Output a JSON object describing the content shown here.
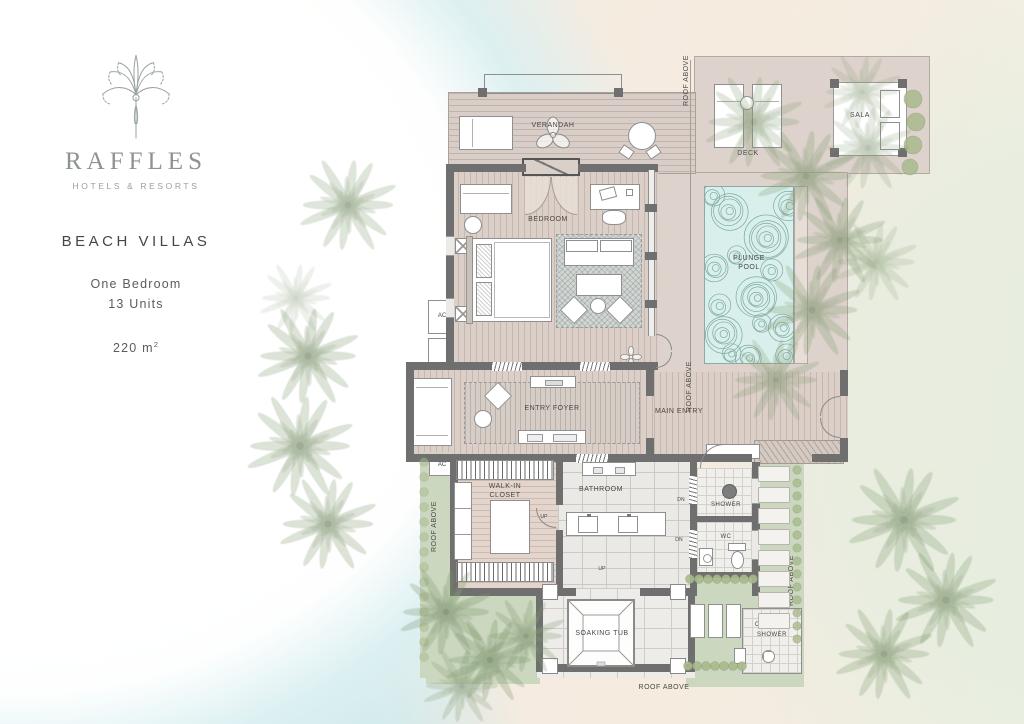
{
  "panel": {
    "brand": "RAFFLES",
    "tagline": "HOTELS & RESORTS",
    "title": "BEACH VILLAS",
    "unit_type": "One Bedroom",
    "unit_count": "13 Units",
    "area": "220 m",
    "area_sup": "2"
  },
  "plan": {
    "labels": {
      "verandah": "VERANDAH",
      "bedroom": "BEDROOM",
      "deck": "DECK",
      "sala": "SALA",
      "plunge_pool_1": "PLUNGE",
      "plunge_pool_2": "POOL",
      "entry_foyer": "ENTRY FOYER",
      "main_entry": "MAIN ENTRY",
      "walk_in_closet_1": "WALK-IN",
      "walk_in_closet_2": "CLOSET",
      "bathroom": "BATHROOM",
      "shower": "SHOWER",
      "wc": "WC",
      "soaking_tub": "SOAKING TUB",
      "outdoor_shower_1": "OUTDOOR",
      "outdoor_shower_2": "SHOWER",
      "roof_above": "ROOF ABOVE",
      "ac": "AC",
      "up": "UP",
      "dn": "DN"
    },
    "colors": {
      "wall": "#6f6f6f",
      "wood_deck": "#d9cec7",
      "pool_water": "#d9efeb",
      "pool_ripple": "#6e9c95",
      "garden_green": "#cbd7be",
      "stone_tile": "#eae9e6",
      "label_text": "#474747",
      "beach_sand": "#f4e9df",
      "water_tint": "#d8eef0"
    }
  }
}
